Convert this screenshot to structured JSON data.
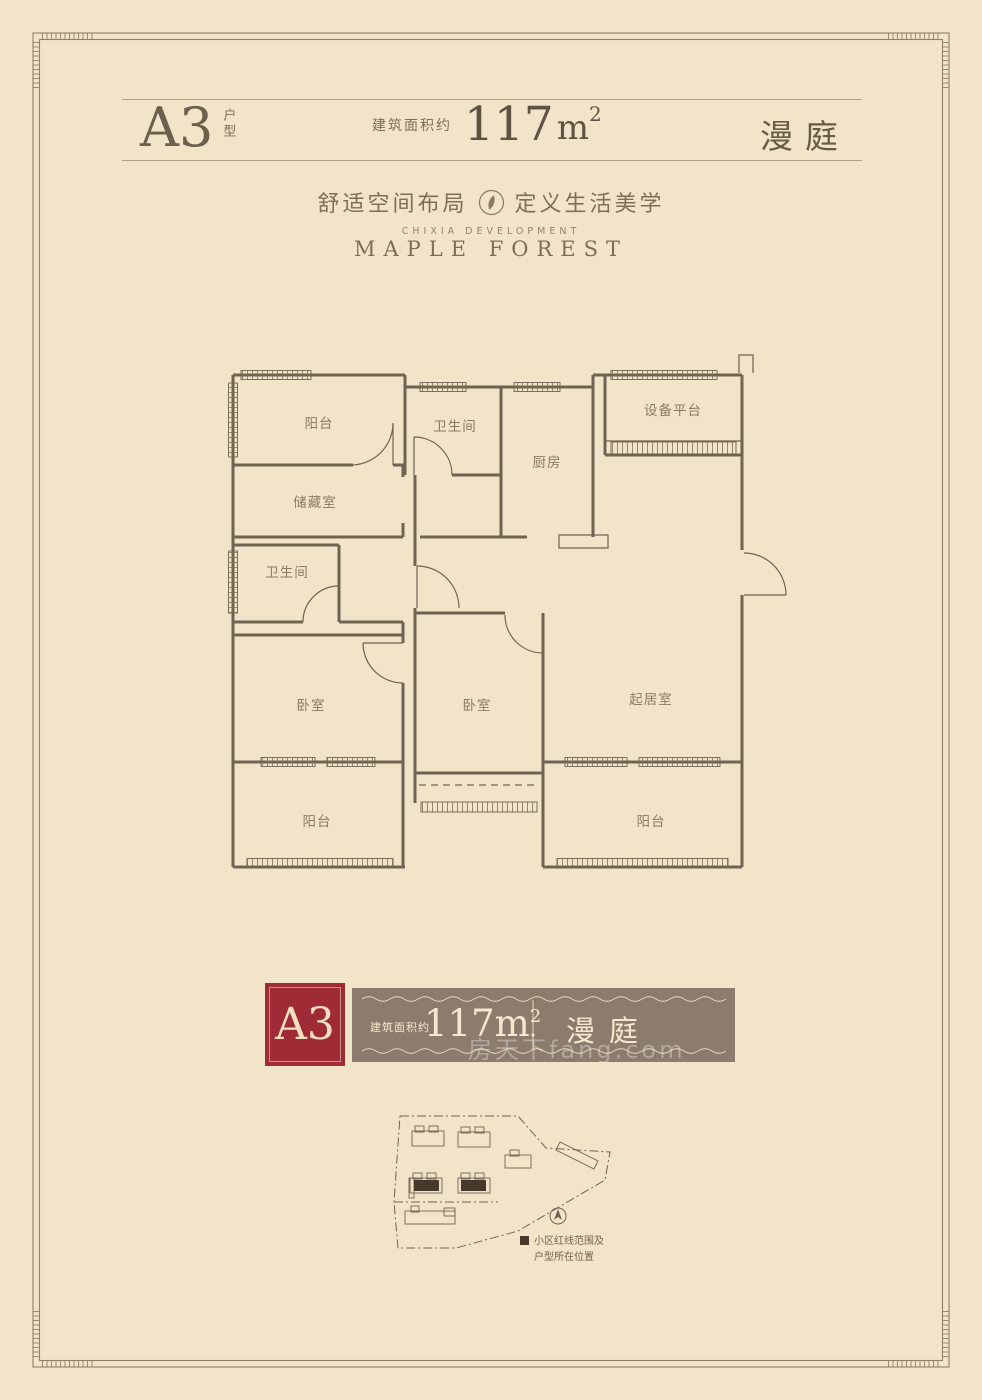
{
  "colors": {
    "background": "#f2e4c8",
    "frame": "#8f8269",
    "wall_line": "#6f6352",
    "room_label": "#8a7b62",
    "accent_red": "#9e2b35",
    "banner_brown": "#8c7c6d",
    "banner_cream": "#f5e9cd",
    "site_highlight": "#46392c"
  },
  "header": {
    "unit_code": "A3",
    "unit_type": "户型",
    "area_prefix": "建筑面积约",
    "area_value": "117",
    "area_unit": "m",
    "area_exp": "2",
    "project_name": "漫庭"
  },
  "tagline": {
    "left": "舒适空间布局",
    "right": "定义生活美学",
    "developer": "CHIXIA DEVELOPMENT",
    "brand": "MAPLE FOREST"
  },
  "floorplan": {
    "rooms": [
      "阳台",
      "卫生间",
      "厨房",
      "设备平台",
      "储藏室",
      "卫生间",
      "卧室",
      "卧室",
      "起居室",
      "阳台",
      "阳台"
    ]
  },
  "banner": {
    "unit_code": "A3",
    "area_prefix": "建筑面积约",
    "area_value": "117",
    "area_unit": "m",
    "area_exp": "2",
    "project_name": "漫庭"
  },
  "site_plan": {
    "legend_line1": "小区红线范围及",
    "legend_line2": "户型所在位置"
  },
  "watermark": "房天下fang.com"
}
